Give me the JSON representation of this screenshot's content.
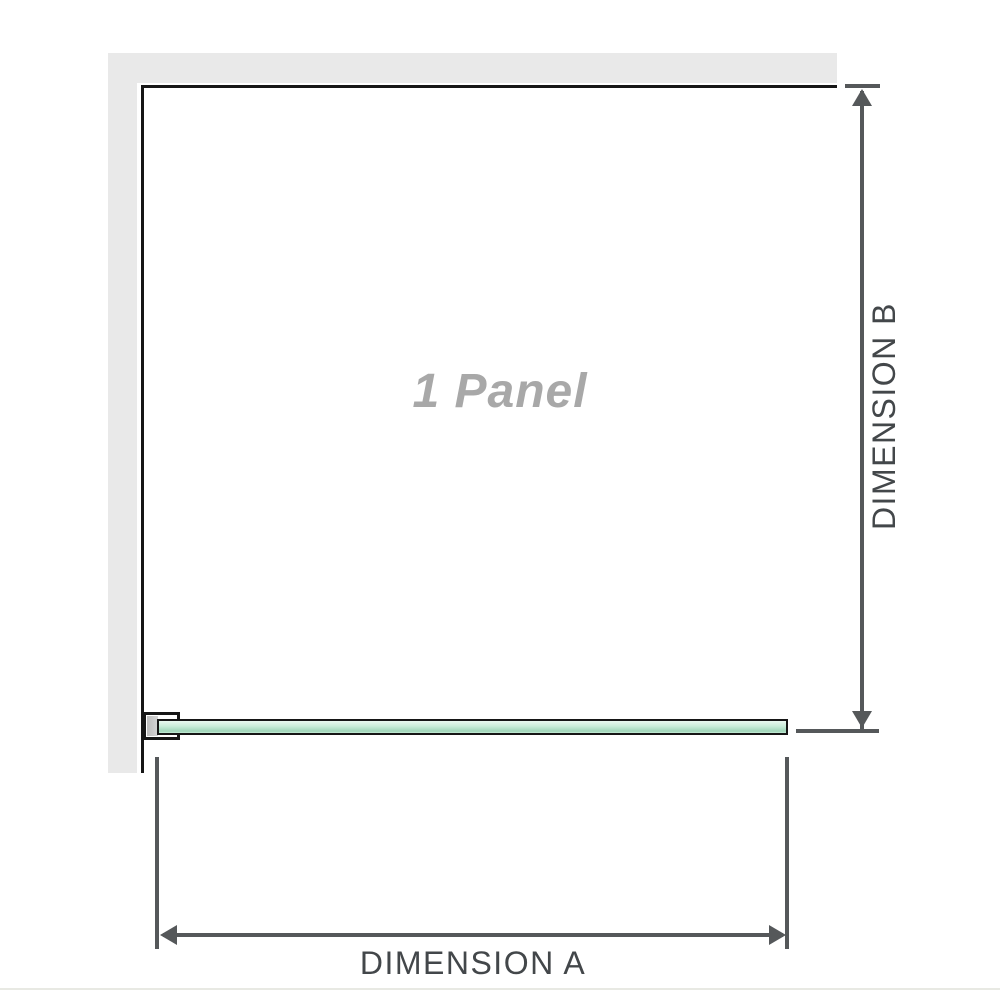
{
  "diagram": {
    "panel_label": "1 Panel",
    "dimensions": {
      "a": {
        "label": "DIMENSION A",
        "orientation": "horizontal"
      },
      "b": {
        "label": "DIMENSION B",
        "orientation": "vertical"
      }
    },
    "elements": {
      "wall": "l-shaped-wall",
      "glass": "glass-panel-top-view",
      "bracket": "wall-mount-bracket"
    }
  },
  "colors": {
    "wall": "#e9e9e9",
    "edge_line": "#161616",
    "dimension_line": "#55585a",
    "label_text": "#43474a",
    "panel_text": "#a8a8a8",
    "glass_light": "#eaf8f0",
    "glass_mid": "#c8ecd8",
    "glass_deep": "#9fd5b8",
    "bracket_fill": "#ffffff",
    "bracket_insert": "#d4d4d4",
    "footer_line": "#e8e9e3"
  }
}
